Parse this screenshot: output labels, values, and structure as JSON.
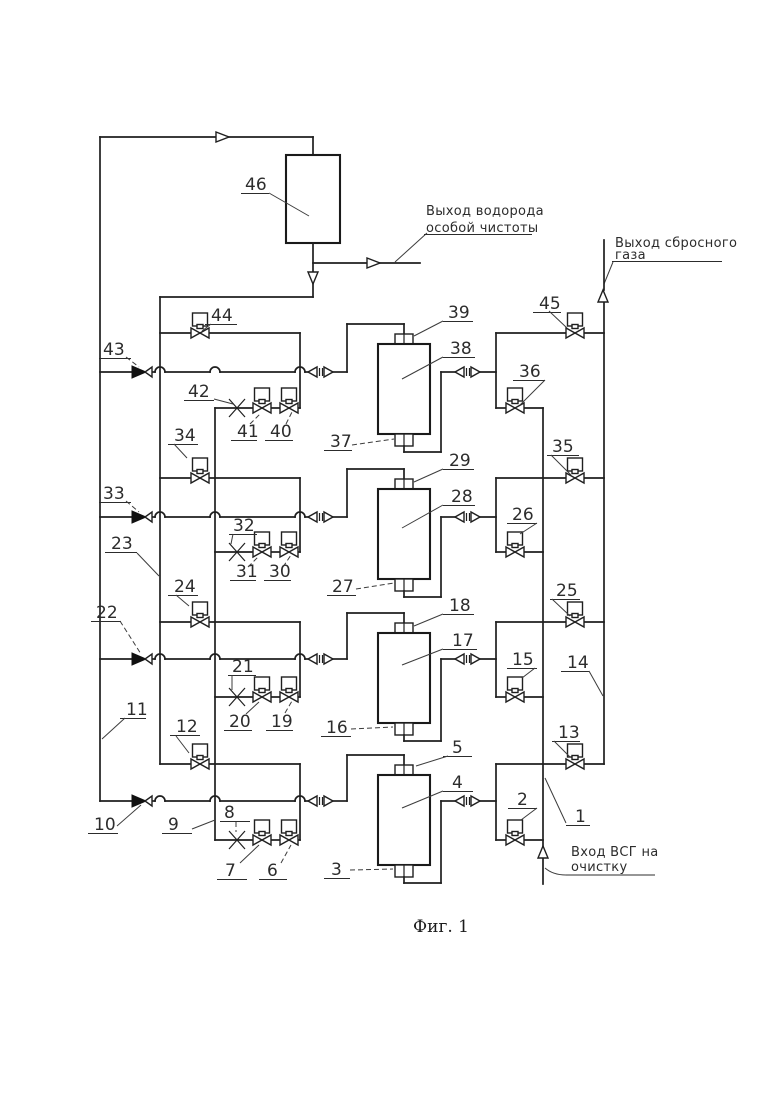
{
  "figure_caption": "Фиг. 1",
  "annotations": {
    "hydrogen_outlet": {
      "line1": "Выход водорода",
      "line2": "особой чистоты"
    },
    "purge_gas_outlet": {
      "line1": "Выход сбросного",
      "line2": "газа"
    },
    "feed_inlet": {
      "line1": "Вход ВСГ на",
      "line2": "очистку"
    }
  },
  "callouts": [
    "1",
    "2",
    "3",
    "4",
    "5",
    "6",
    "7",
    "8",
    "9",
    "10",
    "11",
    "12",
    "13",
    "14",
    "15",
    "16",
    "17",
    "18",
    "19",
    "20",
    "21",
    "22",
    "23",
    "24",
    "25",
    "26",
    "27",
    "28",
    "29",
    "30",
    "31",
    "32",
    "33",
    "34",
    "35",
    "36",
    "37",
    "38",
    "39",
    "40",
    "41",
    "42",
    "43",
    "44",
    "45",
    "46"
  ],
  "stages": [
    {
      "adsorber": "38",
      "top_port": "39",
      "bottom_port": "37",
      "purge_valve": "44",
      "check_valve": "43",
      "manual_valve": "42",
      "valve_a": "41",
      "valve_b": "40",
      "vent_valve": "45",
      "feed_valve": "36"
    },
    {
      "adsorber": "28",
      "top_port": "29",
      "bottom_port": "27",
      "purge_valve": "34",
      "check_valve": "33",
      "manual_valve": "32",
      "valve_a": "31",
      "valve_b": "30",
      "vent_valve": "35",
      "feed_valve": "26"
    },
    {
      "adsorber": "17",
      "top_port": "18",
      "bottom_port": "16",
      "purge_valve": "24",
      "check_valve": "22",
      "manual_valve": "21",
      "valve_a": "20",
      "valve_b": "19",
      "vent_valve": "25",
      "feed_valve": "15"
    },
    {
      "adsorber": "4",
      "top_port": "5",
      "bottom_port": "3",
      "purge_valve": "12",
      "check_valve": "10",
      "manual_valve": "8",
      "valve_a": "7",
      "valve_b": "6",
      "vent_valve": "13",
      "feed_valve": "2"
    }
  ],
  "headers": {
    "product_line": "11",
    "purge_header": "23",
    "left_manifold": "9",
    "feed_header": "1",
    "vent_header": "14",
    "receiver_vessel": "46"
  }
}
